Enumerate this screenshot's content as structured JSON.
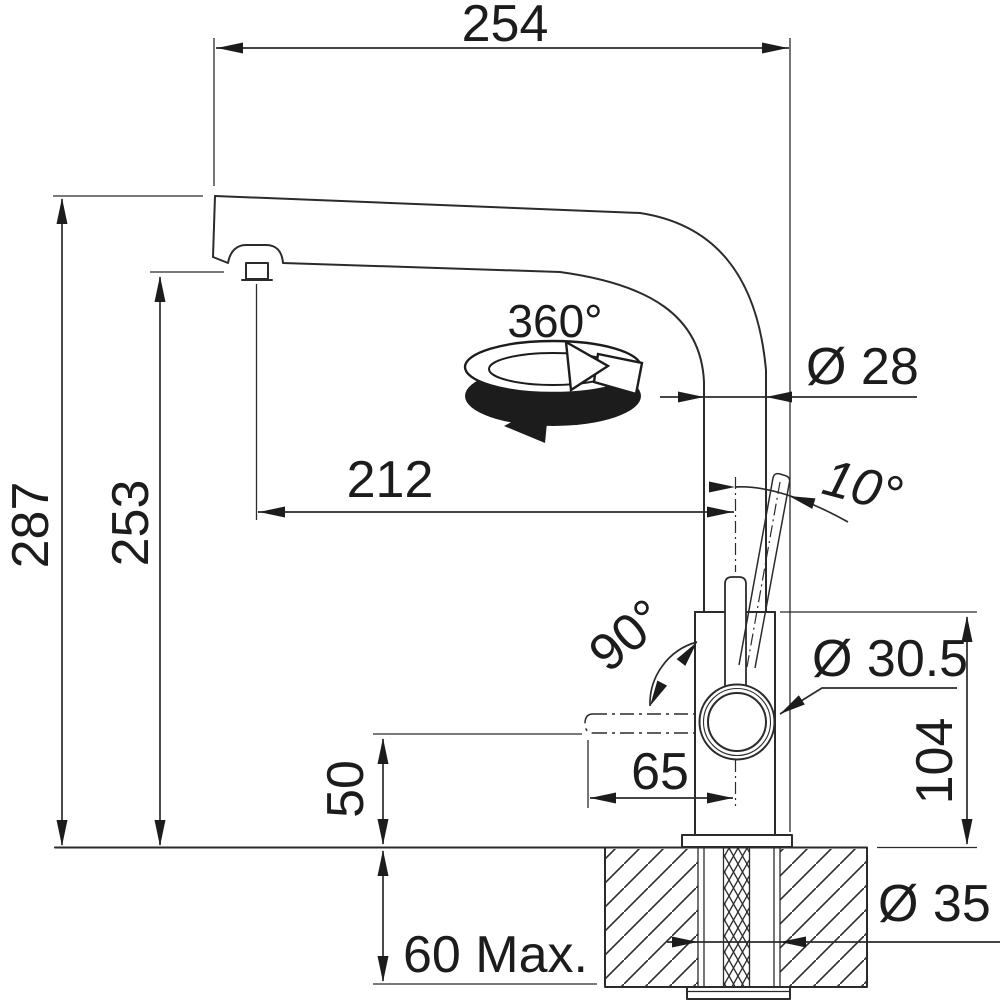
{
  "title": "Faucet technical dimension drawing",
  "colors": {
    "line": "#2b2b2b",
    "text": "#1c1c1c",
    "background": "#ffffff"
  },
  "labels": {
    "width_overall": "254",
    "height_overall": "287",
    "height_spout": "253",
    "reach_spout": "212",
    "swivel_rotation": "360°",
    "pipe_diameter": "Ø 28",
    "lever_tilt_angle": "10°",
    "outlet_swing_angle": "90°",
    "ring_diameter": "Ø 30.5",
    "outlet_offset": "65",
    "body_height": "104",
    "outlet_height": "50",
    "counter_thickness": "60 Max.",
    "hole_diameter": "Ø 35"
  }
}
